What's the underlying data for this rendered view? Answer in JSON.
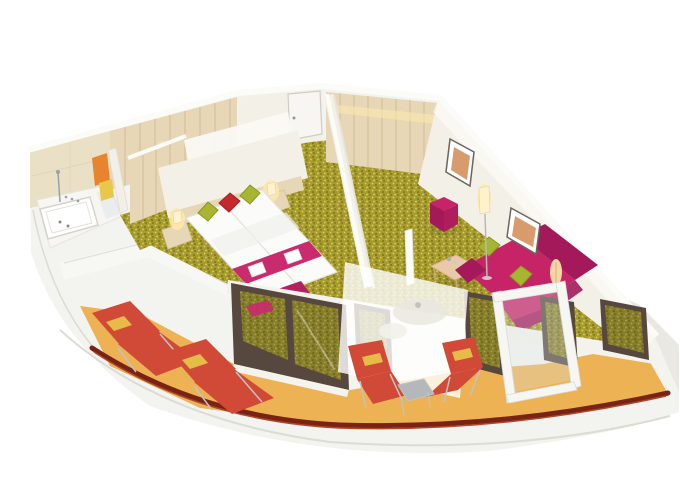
{
  "scene": {
    "type": "3d-floorplan-render",
    "subject": "cruise-ship-suite-cutaway-with-balcony",
    "rooms": [
      {
        "name": "bathroom",
        "items": [
          "bathtub",
          "shower",
          "faucet",
          "glass-partition",
          "orange-towel",
          "yellow-towel"
        ]
      },
      {
        "name": "dressing-corridor",
        "items": [
          "wood-wardrobe",
          "white-door"
        ]
      },
      {
        "name": "entry",
        "items": [
          "entry-door"
        ]
      },
      {
        "name": "bedroom",
        "items": [
          "double-bed",
          "green-pillow-left",
          "red-pillow",
          "green-pillow-right",
          "magenta-bed-runner",
          "towel-set",
          "nightstand-left",
          "nightstand-right",
          "bedside-lamp-left",
          "bedside-lamp-right",
          "foot-bench",
          "panorama-window"
        ]
      },
      {
        "name": "living-room",
        "items": [
          "wood-wardrobe",
          "magenta-sofa",
          "green-cushion-1",
          "green-cushion-2",
          "magenta-armchair",
          "coffee-table",
          "ottoman-cube",
          "floor-lamp",
          "white-column-lamp",
          "wall-art-1",
          "wall-art-2",
          "wall-sconce"
        ]
      },
      {
        "name": "balcony",
        "items": [
          "sun-lounger-1",
          "sun-lounger-2",
          "deck-chair-1",
          "deck-chair-2",
          "side-table",
          "frosted-privacy-screen",
          "round-table",
          "open-glass-door",
          "hull-railing"
        ]
      }
    ]
  },
  "colors": {
    "background": "#ffffff",
    "hull": "#f3f3ef",
    "hull_facet": "#e9e8e3",
    "hull_edge": "#dcdbd4",
    "rail": "#7a2315",
    "rail_hi": "#a8492c",
    "deck": "#ecb253",
    "carpet": "#a79b2e",
    "carpet_dot_light": "#d8ce67",
    "carpet_dot_dark": "#5e5a15",
    "wall": "#f3f1e7",
    "wall_cap": "#fbfbf8",
    "wall_shade": "#e7e4d8",
    "wood": "#e7d7b6",
    "wood_line": "#cdb890",
    "tile": "#e9e0c6",
    "bath_floor": "#f7f6f2",
    "fixture": "#9aa0a6",
    "towel_orange": "#e8832e",
    "towel_yellow": "#e8c84a",
    "bed_white": "#fbfbfa",
    "bed_shade": "#efefeb",
    "runner": "#ca2a6e",
    "bench": "#b3215f",
    "pillow_green": "#a8b530",
    "pillow_green_edge": "#899726",
    "pillow_red": "#c42a2d",
    "sofa": "#c72367",
    "sofa_dark": "#a3195a",
    "table_wood": "#e9c9a8",
    "lamp_glow": "#ffe9ad",
    "lamp_shade": "#fff3cf",
    "art_orange": "#d08a52",
    "frame_dark": "#6b655e",
    "window_frame": "#57483f",
    "glass_dark": "#3f3a22",
    "mullion": "#f3f2ec",
    "lounger": "#d14a38",
    "lounger_frame": "#c0c3c5",
    "door_frame": "#f6f6f3",
    "door_glass": "#dde6e8",
    "metal": "#b5b8ba"
  }
}
